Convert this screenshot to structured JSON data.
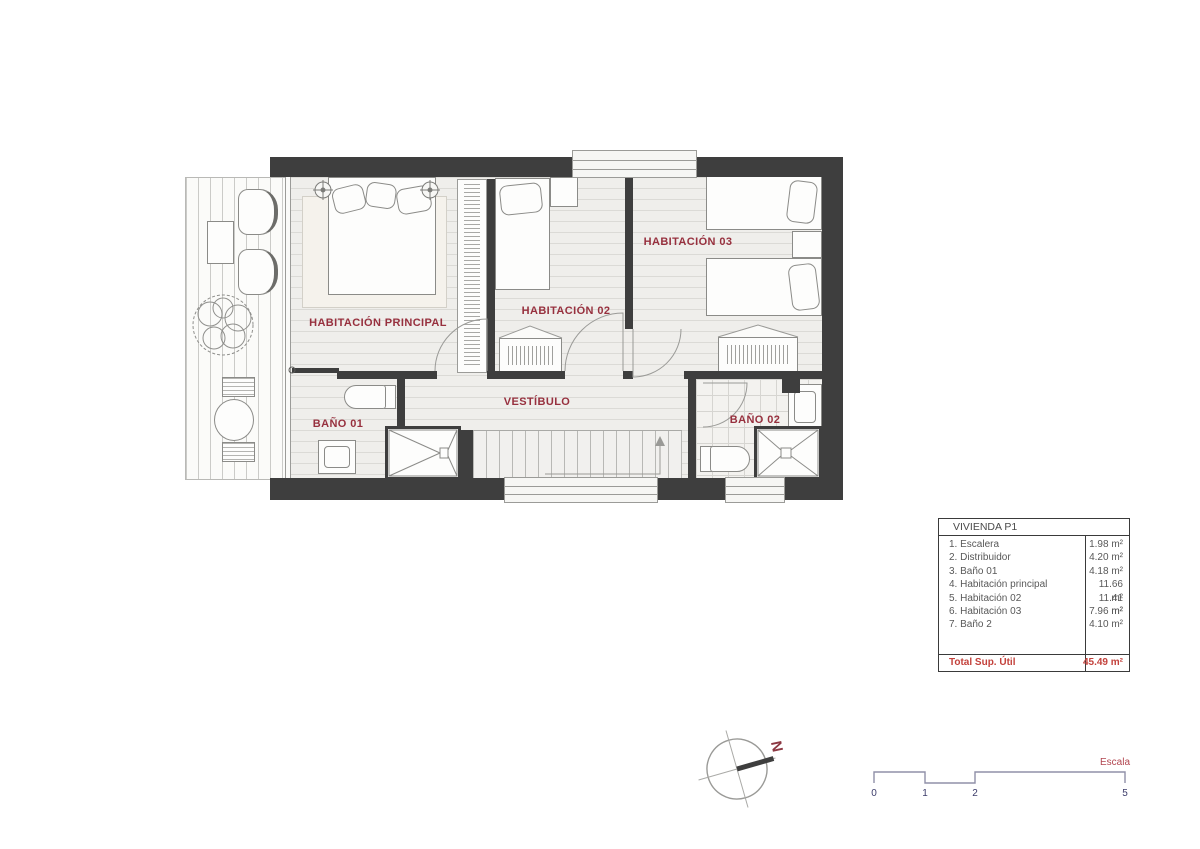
{
  "plan": {
    "rooms": {
      "principal": "HABITACIÓN PRINCIPAL",
      "hab02": "HABITACIÓN 02",
      "hab03": "HABITACIÓN 03",
      "vestibulo": "VESTÍBULO",
      "bano01": "BAÑO 01",
      "bano02": "BAÑO 02"
    }
  },
  "legend": {
    "title": "VIVIENDA P1",
    "rows": [
      {
        "name": "1. Escalera",
        "area": "1.98 m²"
      },
      {
        "name": "2. Distribuidor",
        "area": "4.20 m²"
      },
      {
        "name": "3. Baño 01",
        "area": "4.18 m²"
      },
      {
        "name": "4. Habitación principal",
        "area": "11.66 m²"
      },
      {
        "name": "5. Habitación 02",
        "area": "11.41 m²"
      },
      {
        "name": "6. Habitación 03",
        "area": "7.96 m²"
      },
      {
        "name": "7. Baño 2",
        "area": "4.10 m²"
      }
    ],
    "total_label": "Total Sup. Útil",
    "total_area": "45.49 m²"
  },
  "compass": {
    "north_label": "N"
  },
  "scale_bar": {
    "label": "Escala",
    "ticks": [
      "0",
      "1",
      "2",
      "5"
    ]
  },
  "colors": {
    "wall": "#3e3e3e",
    "room_label": "#97303e",
    "total_red": "#c3413b",
    "scale_numbers": "#3c3c6a"
  }
}
